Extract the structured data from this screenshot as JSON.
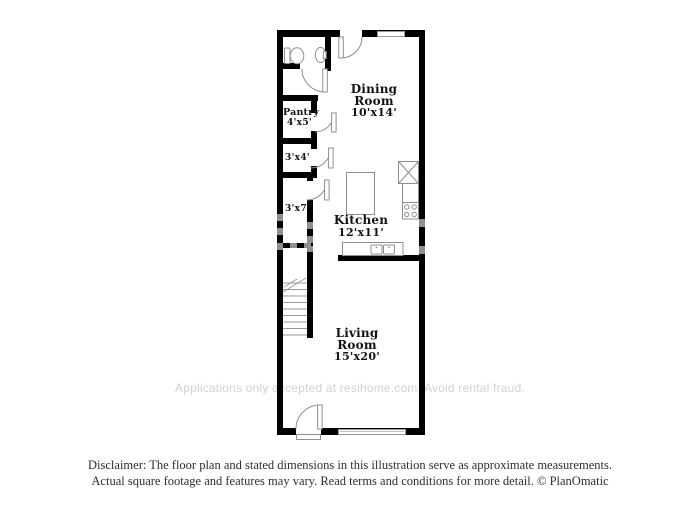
{
  "rooms": {
    "dining": {
      "name": "Dining Room",
      "dims": "10'x14'"
    },
    "pantry": {
      "name": "Pantry",
      "dims": "4'x5'"
    },
    "closet_a": {
      "dims": "3'x4'"
    },
    "closet_b": {
      "dims": "3'x7'"
    },
    "kitchen": {
      "name": "Kitchen",
      "dims": "12'x11'"
    },
    "living": {
      "name": "Living Room",
      "dims": "15'x20'"
    }
  },
  "watermark": "Applications only accepted at resihome.com. Avoid rental fraud.",
  "disclaimer": {
    "line1": "Disclaimer: The floor plan and stated dimensions in this illustration serve as approximate measurements.",
    "line2": "Actual square footage and features may vary. Read terms and conditions for more detail. © PlanOmatic"
  },
  "colors": {
    "wall": "#000000",
    "fixture_line": "#8f8f8f",
    "label_text": "#131313",
    "watermark_text": "#d2d2d2",
    "disclaimer_text": "#2e2e2e",
    "background": "#ffffff"
  }
}
